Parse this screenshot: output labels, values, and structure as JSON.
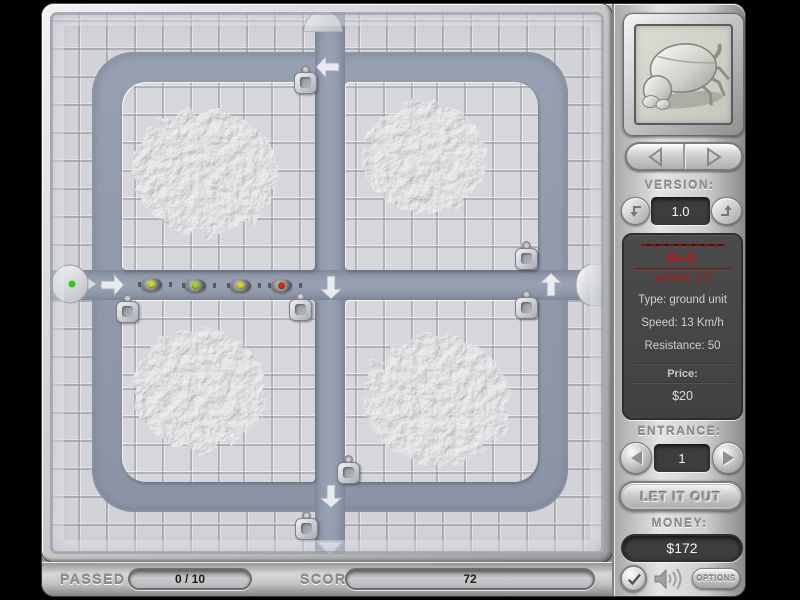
{
  "status": {
    "passed_label": "PASSED",
    "passed_value": "0 / 10",
    "score_label": "SCORE",
    "score_value": "72"
  },
  "panel": {
    "portrait_unit": "beetle",
    "version_label": "VERSION:",
    "version_value": "1.0",
    "info": {
      "name": "BuG",
      "version": "version 1.0",
      "type": "Type: ground unit",
      "speed": "Speed: 13 Km/h",
      "resistance": "Resistance: 50",
      "price_label": "Price:",
      "price_value": "$20"
    },
    "entrance_label": "ENTRANCE:",
    "entrance_value": "1",
    "release_label": "LET IT OUT",
    "money_label": "MONEY:",
    "money_value": "$172",
    "options_label": "OPTIONS"
  },
  "board": {
    "sprites": {
      "towers": [
        [
          256,
          70
        ],
        [
          78,
          299
        ],
        [
          251,
          297
        ],
        [
          477,
          246
        ],
        [
          477,
          295
        ],
        [
          299,
          460
        ],
        [
          257,
          516
        ]
      ],
      "bugs": [
        {
          "x": 102,
          "y": 272,
          "dot": "#ccd81f"
        },
        {
          "x": 146,
          "y": 273,
          "dot": "#9ccf1e"
        },
        {
          "x": 191,
          "y": 273,
          "dot": "#ccd81f"
        },
        {
          "x": 232,
          "y": 273,
          "dot": "#d22b1f"
        }
      ],
      "arrows": [
        {
          "x": 278,
          "y": 55,
          "dir": "left"
        },
        {
          "x": 62,
          "y": 273,
          "dir": "right"
        },
        {
          "x": 281,
          "y": 275,
          "dir": "down"
        },
        {
          "x": 501,
          "y": 273,
          "dir": "up"
        },
        {
          "x": 281,
          "y": 484,
          "dir": "down"
        }
      ],
      "exit_marker": {
        "x": 280,
        "y": 537
      }
    }
  },
  "colors": {
    "path": "#929BAC",
    "tile": "#d4d5d9",
    "accent_red": "#c01818",
    "panel_dark": "#474747",
    "entrance_light": "#35c818"
  }
}
